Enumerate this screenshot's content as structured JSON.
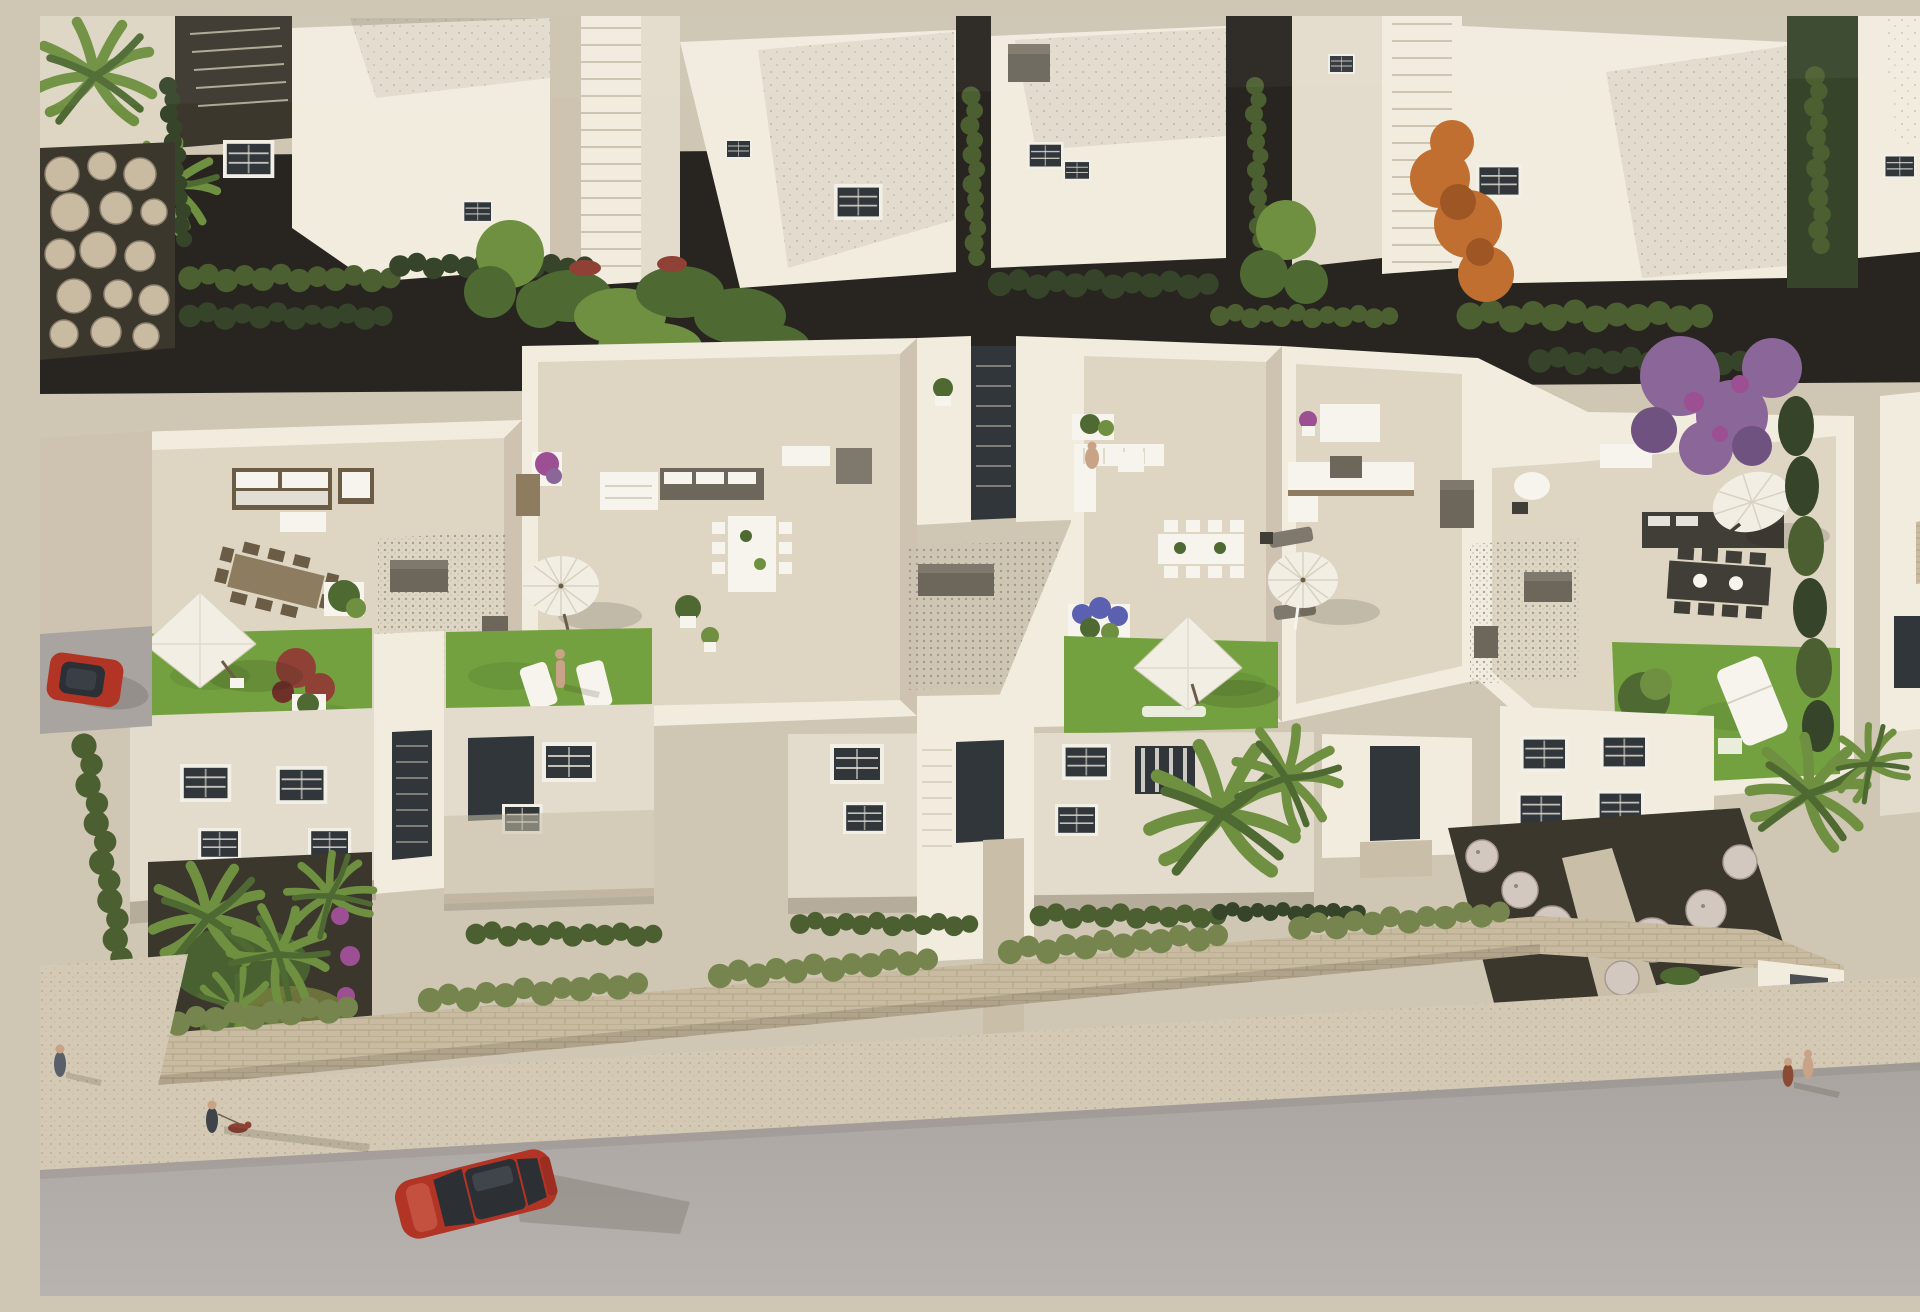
{
  "scene": {
    "type": "architectural-aerial-render",
    "description": "Aerial 3D rendering of a modern white townhouse development: four rooftop terraces with parasols, outdoor sofas, dining sets and lawns; an upper row of white houses with flat grey roofs separated by stair alleys and hedges; front gardens with palm trees, a perimeter stone wall, a sidewalk and a street with a parked red car, a second red car, pedestrians and a dog walker.",
    "counts": {
      "rooftop_terraces": 4,
      "parasols": 5,
      "red_cars": 2,
      "people": 6,
      "dogs": 1,
      "external_staircases": 2
    },
    "objects": [
      "square-parasol",
      "round-parasol",
      "fringed-parasol",
      "tilted-parasol",
      "outdoor-sofa",
      "dining-table",
      "sun-lounger",
      "storage-box",
      "gravel-court",
      "roof-lawn",
      "red-shrub",
      "blue-flower-planter",
      "palm-tree",
      "orange-tree",
      "purple-bougainvillea",
      "boulder-wall",
      "stone-balls-garden",
      "perimeter-wall",
      "hedge-row",
      "stair-alley",
      "red-car",
      "pedestrian",
      "dog"
    ]
  },
  "colors": {
    "ground": "#cfc6b3",
    "wall-lit": "#f2ecdf",
    "wall-mid": "#e3dbcb",
    "wall-shade": "#cdc3b0",
    "wall-dark": "#b7ad9b",
    "roof-gray": "#c7c3b6",
    "floor-tile": "#ded6c3",
    "floor-shade": "#c9bfa9",
    "lawn": "#74a140",
    "lawn-dark": "#5e8b33",
    "hedge": "#4c5f31",
    "hedge-dark": "#36452a",
    "hedge-light": "#76854d",
    "soil": "#3b372d",
    "soil-dark": "#282520",
    "street": "#aaa4a1",
    "street-light": "#b9b3b0",
    "sidewalk": "#d3c9b4",
    "gravel": "#b5b0a6",
    "gravel-dark": "#8e897f",
    "window-glass": "#31363b",
    "window-frame": "#f2efe7",
    "wood": "#8d7c5f",
    "wood-dark": "#6b5c46",
    "dark-box": "#6c665b",
    "dark-box-top": "#7f786c",
    "sofa-dark": "#413d37",
    "white": "#f7f4ed",
    "umbrella": "#f2eee4",
    "umbrella-shade": "#d8d2c2",
    "car-red": "#b23425",
    "glass-dark": "#2c3034",
    "tree-green": "#4e6a32",
    "tree-green-light": "#6e9040",
    "orange-tree": "#c06f30",
    "orange-tree-dark": "#9e5624",
    "purple-tree": "#8b6699",
    "purple-flower": "#9c4f92",
    "blue-flower": "#5b60b0",
    "red-shrub": "#8f4136",
    "stone-wall": "#c8bba1",
    "stone-joint": "#a79878",
    "stone-ball": "#d3c8c0",
    "skin": "#c9a387"
  }
}
